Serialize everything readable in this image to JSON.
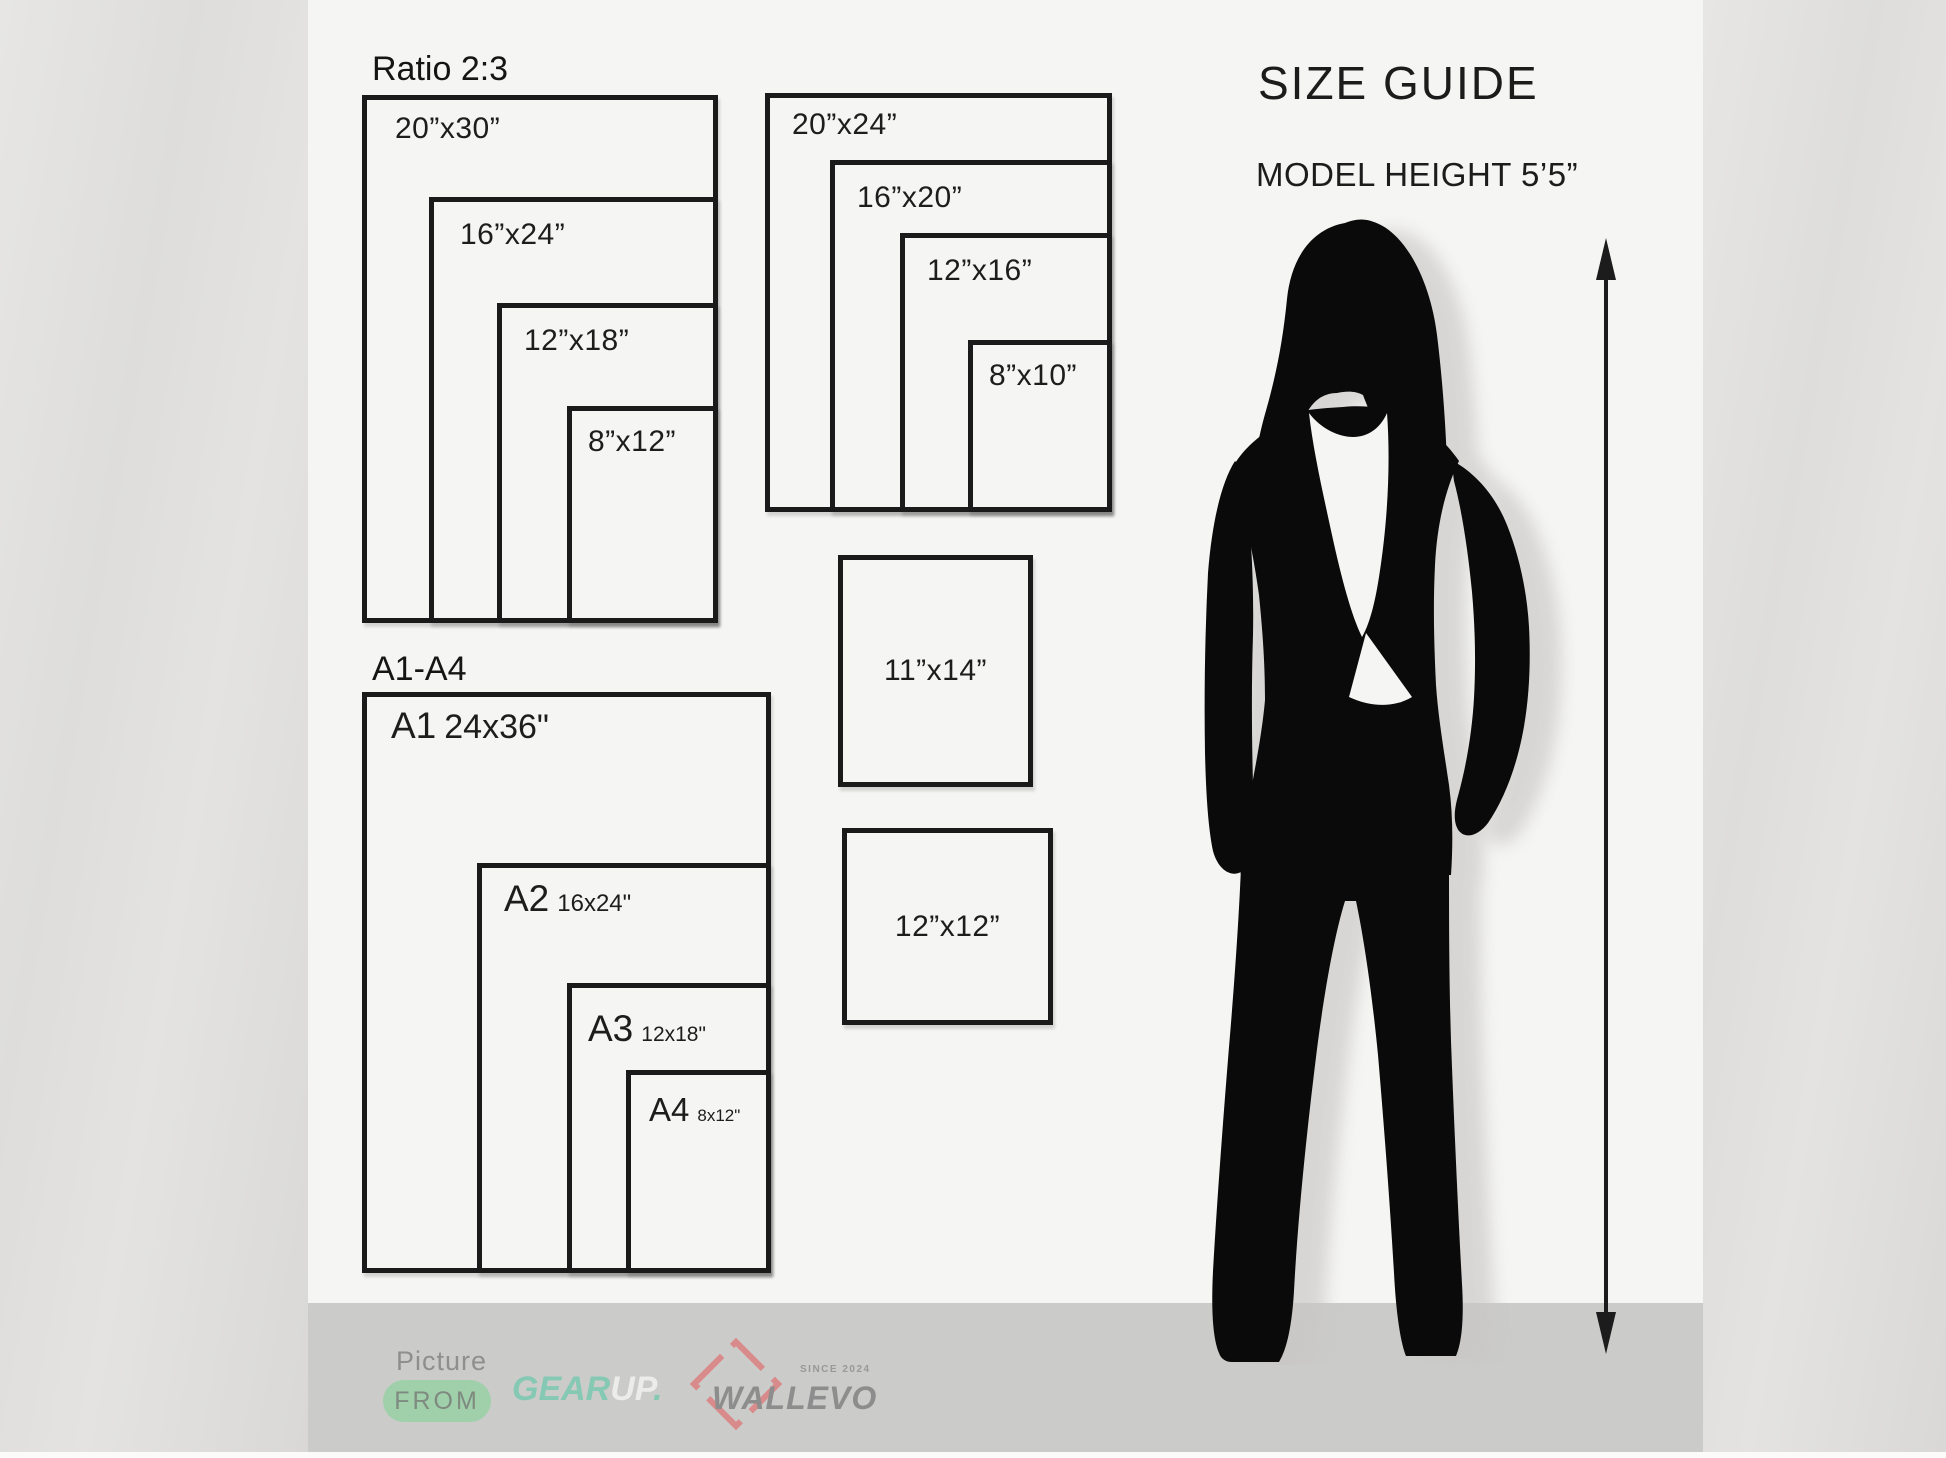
{
  "header": {
    "title": "SIZE GUIDE",
    "subtitle": "MODEL HEIGHT 5’5”"
  },
  "ratio_group": {
    "heading": "Ratio 2:3",
    "frames": [
      "20”x30”",
      "16”x24”",
      "12”x18”",
      "8”x12”"
    ]
  },
  "standard_group": {
    "frames": [
      "20”x24”",
      "16”x20”",
      "12”x16”",
      "8”x10”"
    ]
  },
  "square_frames": [
    "11”x14”",
    "12”x12”"
  ],
  "a_series_group": {
    "heading": "A1-A4",
    "frames": [
      {
        "name": "A1",
        "size": "24x36\""
      },
      {
        "name": "A2",
        "size": "16x24\""
      },
      {
        "name": "A3",
        "size": "12x18\""
      },
      {
        "name": "A4",
        "size": "8x12\""
      }
    ]
  },
  "footer": {
    "picture_label": "Picture",
    "from_label": "FROM",
    "gearup": {
      "part1": "GEAR",
      "part2": "UP",
      "dot": "."
    },
    "wallevo": {
      "name": "WALLEVO",
      "since": "SINCE 2024"
    }
  },
  "colors": {
    "frame_border": "#1a1a1a",
    "panel_bg": "#f5f5f3",
    "outer_bg": "#e2e1df",
    "footer_bg": "#cbcbca",
    "pill_green": "#9fd0aa",
    "gear_teal": "#85c9b4",
    "up_white": "#ececea",
    "wallevo_gray": "#8d8d8d",
    "diamond_red": "#d98a8a",
    "silhouette_black": "#0a0a0a"
  }
}
